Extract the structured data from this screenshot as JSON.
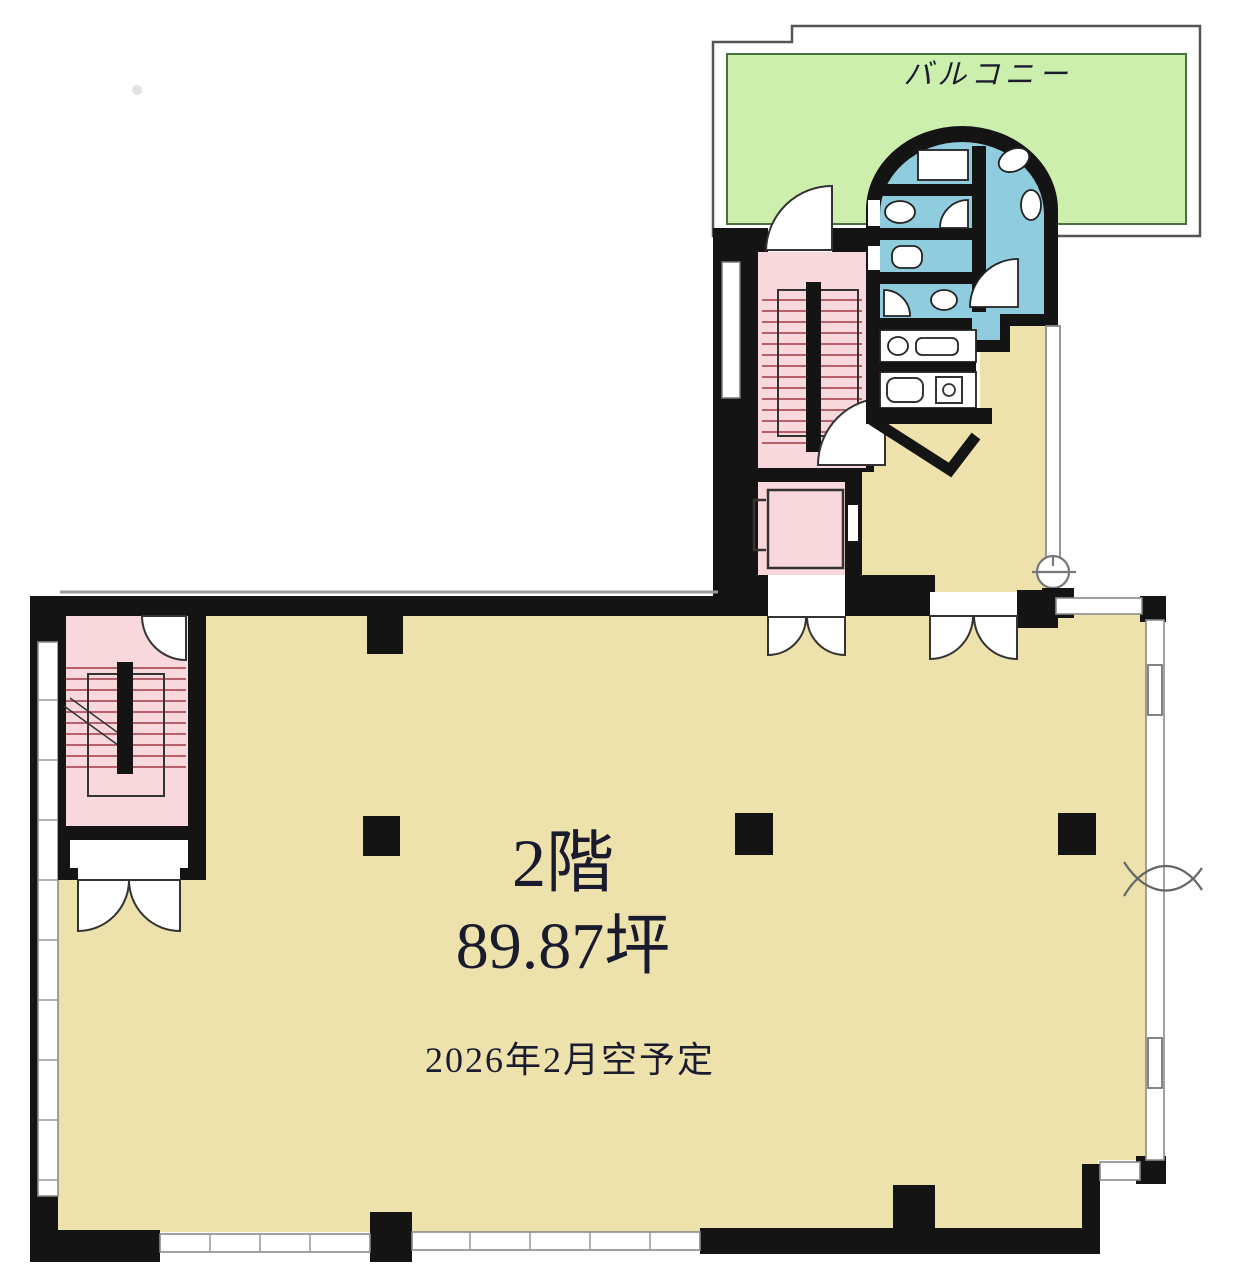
{
  "balcony": {
    "label": "バルコニー"
  },
  "main_room": {
    "floor_label": "2階",
    "area_label": "89.87坪",
    "availability_label": "2026年2月空予定"
  },
  "colors": {
    "floor": "#EDE2AC",
    "balcony": "#CDEFAE",
    "balcony_border": "#4a7040",
    "stairs": "#F8D8DD",
    "restroom": "#8ECCDE",
    "wall": "#141414",
    "window_line": "#8a8a8a",
    "outline": "#555555",
    "tread_line": "#b8606c",
    "text": "#1b1b2f"
  }
}
